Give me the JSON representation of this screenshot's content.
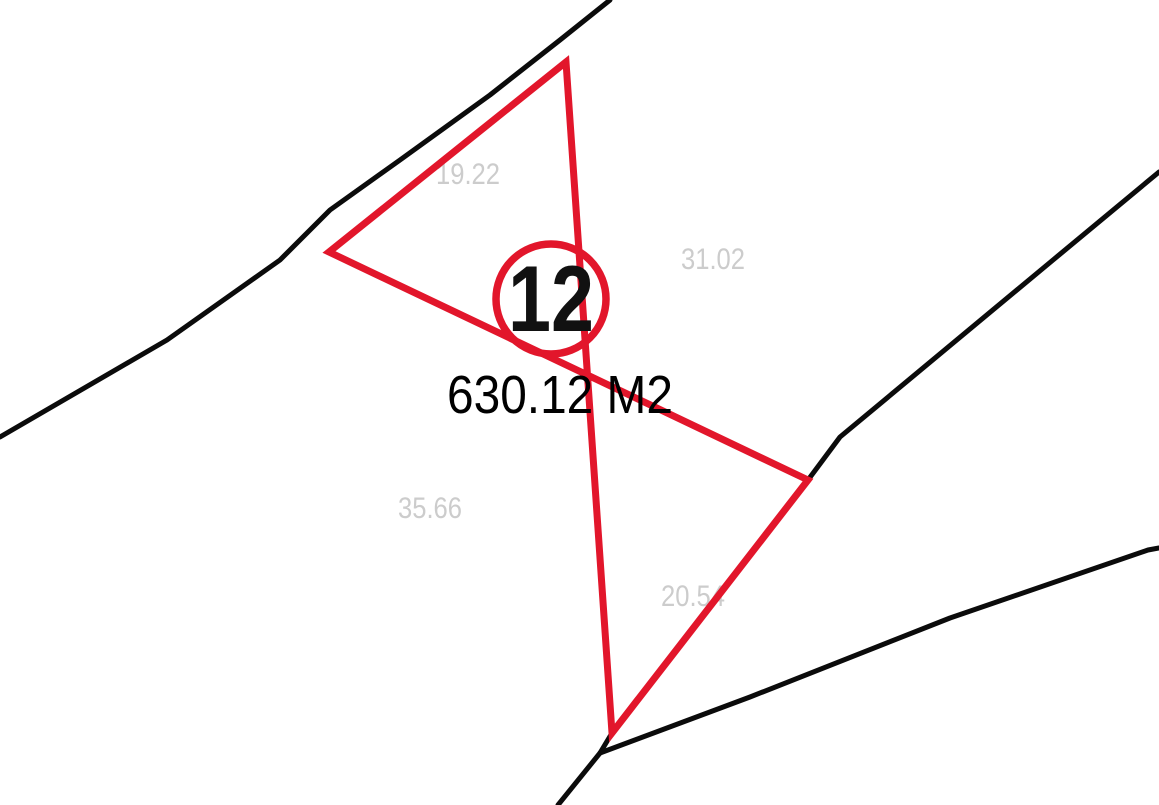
{
  "page": {
    "background": "#ffffff"
  },
  "parcel": {
    "lot_number": "12",
    "area_label": "630.12 M2",
    "dimensions": [
      {
        "side": "northwest",
        "value": "19.22",
        "x": 468,
        "y": 184
      },
      {
        "side": "northeast",
        "value": "31.02",
        "x": 713,
        "y": 269
      },
      {
        "side": "southwest",
        "value": "35.66",
        "x": 430,
        "y": 518
      },
      {
        "side": "southeast",
        "value": "20.54",
        "x": 693,
        "y": 606
      }
    ]
  },
  "colors": {
    "parcel_outline": "#e2162b",
    "boundary_line": "#0b0b0b",
    "dimension_text": "#cccccc",
    "lot_number_text": "#111111",
    "area_text": "#000000"
  },
  "geometry": {
    "parcel_polygon": "566,62 329,252 808,480 612,733",
    "boundary_lines": [
      "610,0 560,40 490,95 400,160 330,210 280,260 167,340 0,437",
      "808,480 840,437 1053,260 1159,172",
      "612,733 600,753 558,805",
      "600,753 750,697 950,618 1148,550 1159,548"
    ],
    "lot_circle": {
      "cx": 551,
      "cy": 299,
      "r": 55,
      "text_y": 331
    },
    "area_text": {
      "x": 560,
      "y": 413
    }
  }
}
